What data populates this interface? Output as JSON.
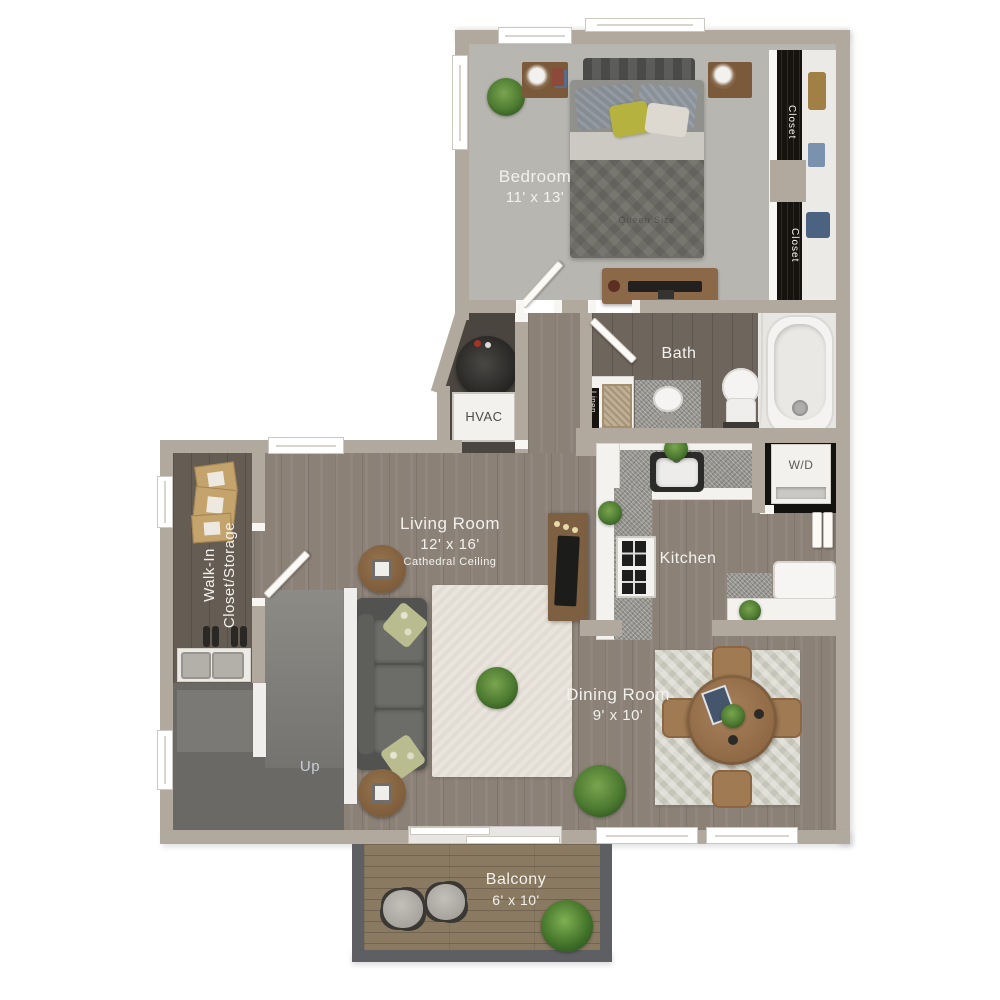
{
  "title": "Apartment Floor Plan",
  "rooms": {
    "bedroom": {
      "name": "Bedroom",
      "dims": "11' x 13'"
    },
    "closet_top": {
      "name": "Closet"
    },
    "closet_bottom": {
      "name": "Closet"
    },
    "bath": {
      "name": "Bath"
    },
    "linen": {
      "name": "Linen"
    },
    "hvac": {
      "name": "HVAC"
    },
    "laundry": {
      "name": "W/D"
    },
    "kitchen": {
      "name": "Kitchen"
    },
    "living_room": {
      "name": "Living Room",
      "dims": "12' x 16'",
      "note": "Cathedral Ceiling"
    },
    "walk_in": {
      "line1": "Walk-In",
      "line2": "Closet/Storage"
    },
    "stairs": {
      "name": "Up"
    },
    "dining_room": {
      "name": "Dining Room",
      "dims": "9' x 10'"
    },
    "balcony": {
      "name": "Balcony",
      "dims": "6' x 10'"
    },
    "bed": {
      "name": "Queen Size"
    }
  },
  "colors": {
    "wall": "#b2a99e",
    "label_text": "#f3f1ed",
    "wood_floor": "#8b8177",
    "bedroom_carpet": "#b8b6b1",
    "closet_interior": "#16120d",
    "balcony_wood": "#8b7a62",
    "plant_green": "#4c7a30"
  }
}
